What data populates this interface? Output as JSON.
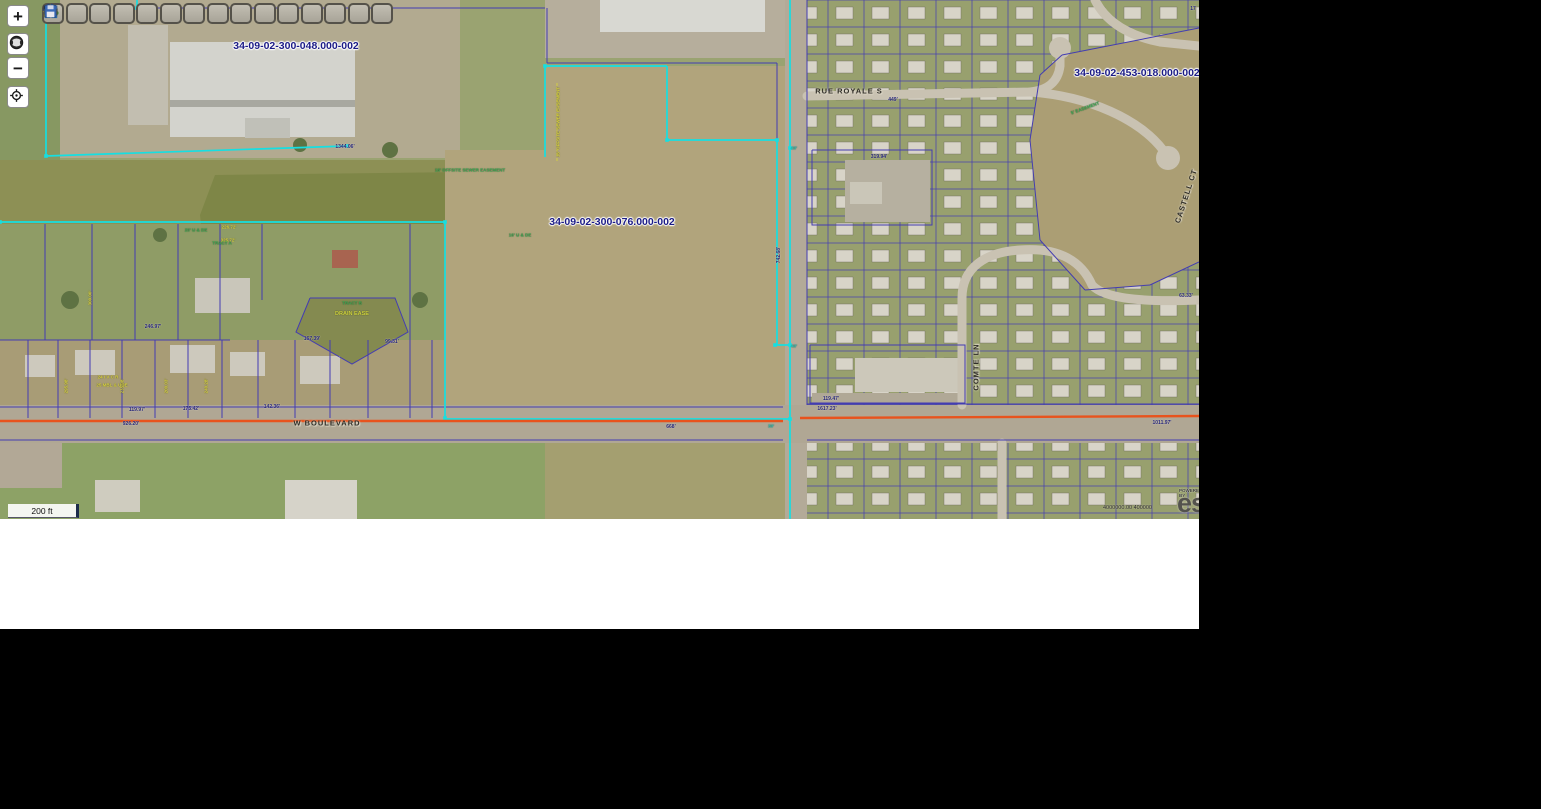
{
  "app": {
    "type": "gis-parcel-viewer"
  },
  "toolbar": {
    "buttons": [
      {
        "icon": "info"
      },
      {
        "icon": "identify-flash"
      },
      {
        "icon": "zoom-select"
      },
      {
        "icon": "pan-hand"
      },
      {
        "icon": "eraser"
      },
      {
        "icon": "add-data"
      },
      {
        "icon": "pushpin"
      },
      {
        "icon": "camera"
      },
      {
        "icon": "measure"
      },
      {
        "icon": "search"
      },
      {
        "icon": "draw-pencil"
      },
      {
        "icon": "select-features"
      },
      {
        "icon": "buffer"
      },
      {
        "icon": "print"
      },
      {
        "icon": "save"
      }
    ]
  },
  "nav": {
    "buttons": [
      {
        "icon": "zoom-in",
        "glyph": "+",
        "top": 5
      },
      {
        "icon": "full-extent-globe",
        "glyph": "",
        "top": 33
      },
      {
        "icon": "zoom-out",
        "glyph": "−",
        "top": 57
      },
      {
        "icon": "locate-crosshair",
        "glyph": "",
        "top": 86
      }
    ]
  },
  "scalebar": {
    "label": "200 ft"
  },
  "attribution": {
    "powered_by": "POWERED BY",
    "brand": "esri",
    "coords": "4000000.00 400000"
  },
  "map": {
    "w": 1199,
    "h": 519,
    "palette": {
      "navy": "#433cb2",
      "cyan": "#15dfe2",
      "orange": "#e8531d",
      "street": "#c9c2b2",
      "road": "#b3aa98",
      "lotbase": "#98a06e",
      "labelNavy": "#1b1b86",
      "labelGreen": "#3fae54",
      "labelYellow": "#d8d23e"
    },
    "fills": [
      {
        "k": "rect",
        "x": 0,
        "y": 0,
        "w": 1199,
        "h": 519,
        "f": "#a89c76"
      },
      {
        "k": "rect",
        "x": 0,
        "y": 0,
        "w": 790,
        "h": 160,
        "f": "#9aa371"
      },
      {
        "k": "rect",
        "x": 60,
        "y": 0,
        "w": 400,
        "h": 158,
        "f": "#b2aa90"
      },
      {
        "k": "rect",
        "x": 0,
        "y": 0,
        "w": 60,
        "h": 160,
        "f": "#879862"
      },
      {
        "k": "rect",
        "x": 128,
        "y": 25,
        "w": 40,
        "h": 100,
        "f": "#c2beb0"
      },
      {
        "k": "rect",
        "x": 170,
        "y": 42,
        "w": 185,
        "h": 95,
        "f": "#d3d3cd"
      },
      {
        "k": "rect",
        "x": 170,
        "y": 100,
        "w": 185,
        "h": 7,
        "f": "#a8a8a0"
      },
      {
        "k": "rect",
        "x": 245,
        "y": 118,
        "w": 45,
        "h": 20,
        "f": "#c0c0b8"
      },
      {
        "k": "rect",
        "x": 545,
        "y": 0,
        "w": 240,
        "h": 58,
        "f": "#b6ae9c"
      },
      {
        "k": "rect",
        "x": 600,
        "y": 0,
        "w": 165,
        "h": 32,
        "f": "#d8d8d2"
      },
      {
        "k": "rect",
        "x": 0,
        "y": 160,
        "w": 690,
        "h": 132,
        "f": "#8d9055"
      },
      {
        "k": "poly",
        "p": "215,175 640,170 668,200 672,250 650,282 240,288 205,260 200,215",
        "f": "#7e8647"
      },
      {
        "k": "rect",
        "x": 445,
        "y": 150,
        "w": 340,
        "h": 268,
        "f": "#b1a47c"
      },
      {
        "k": "rect",
        "x": 545,
        "y": 66,
        "w": 240,
        "h": 90,
        "f": "#b1a47c"
      },
      {
        "k": "rect",
        "x": 0,
        "y": 224,
        "w": 445,
        "h": 116,
        "f": "#8f9c66"
      },
      {
        "k": "circ",
        "cx": 70,
        "cy": 300,
        "r": 9,
        "f": "#5e7243"
      },
      {
        "k": "circ",
        "cx": 160,
        "cy": 235,
        "r": 7,
        "f": "#5e7243"
      },
      {
        "k": "circ",
        "cx": 420,
        "cy": 300,
        "r": 8,
        "f": "#5e7243"
      },
      {
        "k": "circ",
        "cx": 300,
        "cy": 145,
        "r": 7,
        "f": "#5e7243"
      },
      {
        "k": "circ",
        "cx": 390,
        "cy": 150,
        "r": 8,
        "f": "#5e7243"
      },
      {
        "k": "poly",
        "p": "310,298 395,298 408,332 352,364 296,332",
        "f": "#848a50"
      },
      {
        "k": "rect",
        "x": 195,
        "y": 278,
        "w": 55,
        "h": 35,
        "f": "#c9c6ba"
      },
      {
        "k": "rect",
        "x": 332,
        "y": 250,
        "w": 26,
        "h": 18,
        "f": "#a86450"
      },
      {
        "k": "rect",
        "x": 25,
        "y": 355,
        "w": 30,
        "h": 22,
        "f": "#cdc9bd"
      },
      {
        "k": "rect",
        "x": 75,
        "y": 350,
        "w": 40,
        "h": 25,
        "f": "#cdc9bd"
      },
      {
        "k": "rect",
        "x": 170,
        "y": 345,
        "w": 45,
        "h": 28,
        "f": "#cdc9bd"
      },
      {
        "k": "rect",
        "x": 230,
        "y": 352,
        "w": 35,
        "h": 24,
        "f": "#cdc9bd"
      },
      {
        "k": "rect",
        "x": 300,
        "y": 356,
        "w": 40,
        "h": 28,
        "f": "#cdc9bd"
      },
      {
        "k": "rect",
        "x": 785,
        "y": 0,
        "w": 22,
        "h": 519,
        "f": "#b3aa98"
      },
      {
        "k": "rect",
        "x": 0,
        "y": 405,
        "w": 1199,
        "h": 38,
        "f": "#b0a794"
      },
      {
        "k": "rect",
        "x": 0,
        "y": 443,
        "w": 545,
        "h": 76,
        "f": "#8da266"
      },
      {
        "k": "rect",
        "x": 285,
        "y": 480,
        "w": 72,
        "h": 39,
        "f": "#d6d3c9"
      },
      {
        "k": "rect",
        "x": 95,
        "y": 480,
        "w": 45,
        "h": 32,
        "f": "#cfccbf"
      },
      {
        "k": "rect",
        "x": 0,
        "y": 443,
        "w": 62,
        "h": 45,
        "f": "#b2a896"
      },
      {
        "k": "rect",
        "x": 545,
        "y": 443,
        "w": 240,
        "h": 76,
        "f": "#a49f70"
      }
    ],
    "pattern_blocks": [
      {
        "p": "807,0 1199,0 1199,405 807,405"
      },
      {
        "p": "807,443 1199,443 1199,519 807,519"
      }
    ],
    "post_fills": [
      {
        "k": "poly",
        "p": "1062,55 1199,28 1199,262 1150,285 1085,290 1040,240 1030,140 1040,75",
        "f": "#ab9e74"
      },
      {
        "k": "rect",
        "x": 845,
        "y": 160,
        "w": 85,
        "h": 62,
        "f": "#b6b0a0"
      },
      {
        "k": "rect",
        "x": 850,
        "y": 182,
        "w": 32,
        "h": 22,
        "f": "#cac6b8"
      },
      {
        "k": "rect",
        "x": 855,
        "y": 358,
        "w": 105,
        "h": 34,
        "f": "#ccc8ba"
      },
      {
        "k": "rect",
        "x": 812,
        "y": 393,
        "w": 150,
        "h": 11,
        "f": "#b0a896"
      }
    ],
    "streets": [
      {
        "d": "M807,96 L1030,92 C1048,90 1058,82 1060,66 L1060,55",
        "w": 9
      },
      {
        "d": "M1030,92 C1090,96 1140,120 1163,150",
        "w": 9
      },
      {
        "d": "M1095,0 C1105,20 1125,35 1160,42 L1199,46",
        "w": 9
      },
      {
        "d": "M962,405 L962,298 C962,268 985,252 1020,250 C1060,247 1082,262 1092,285 C1105,300 1150,302 1199,300",
        "w": 9
      },
      {
        "d": "M1002,443 L1002,519",
        "w": 9
      }
    ],
    "culdesacs": [
      {
        "cx": 1060,
        "cy": 48,
        "r": 11
      },
      {
        "cx": 1168,
        "cy": 158,
        "r": 12
      },
      {
        "cx": 1020,
        "cy": 250,
        "r": 2
      }
    ],
    "navy": [
      "0,340 230,340",
      "45,224 45,340",
      "92,224 92,340",
      "135,224 135,340",
      "178,224 178,340",
      "220,224 220,340",
      "262,224 262,300",
      "410,224 410,418",
      "310,298 395,298 408,332 352,364 296,332 310,298",
      "28,340 28,418",
      "58,340 58,418",
      "90,340 90,418",
      "122,340 122,418",
      "155,340 155,418",
      "188,340 188,418",
      "222,340 222,418",
      "258,340 258,418",
      "295,340 295,418",
      "330,340 330,418",
      "368,340 368,418",
      "432,340 432,418",
      "0,407 783,407",
      "0,440 783,440",
      "807,404 1199,404",
      "807,440 1199,440",
      "137,0 137,8",
      "137,8 545,8",
      "547,8 547,63",
      "547,63 777,63",
      "777,63 777,140",
      "807,0 807,405",
      "1062,55 1199,28",
      "1040,75 1062,55",
      "1030,140 1040,75",
      "1040,240 1030,140",
      "1085,290 1040,240",
      "1150,285 1085,290",
      "1199,262 1150,285",
      "812,150 932,150 932,225 812,225 812,150",
      "810,345 965,345 965,403 810,403 810,345"
    ],
    "cyan": [
      "137,0 137,8",
      "46,20 46,156",
      "46,156 347,146",
      "0,222 445,222",
      "445,222 445,418",
      "545,66 667,66",
      "667,66 667,140",
      "667,140 777,140",
      "777,140 777,345",
      "545,66 545,157",
      "790,0 790,519",
      "445,419 790,419",
      "775,345 790,345"
    ],
    "cyan_markers": [
      [
        137,
        8
      ],
      [
        46,
        156
      ],
      [
        347,
        146
      ],
      [
        0,
        222
      ],
      [
        445,
        222
      ],
      [
        445,
        418
      ],
      [
        545,
        66
      ],
      [
        667,
        140
      ],
      [
        777,
        140
      ],
      [
        790,
        148
      ],
      [
        790,
        345
      ],
      [
        790,
        419
      ],
      [
        775,
        345
      ]
    ],
    "orange": [
      {
        "d": "M0,421 L783,421",
        "w": 2.4
      },
      {
        "d": "M800,418 L1199,416",
        "w": 2.4
      }
    ],
    "dash": [
      {
        "d": "M557,83 L557,163"
      }
    ],
    "labels": [
      {
        "t": "34-09-02-300-048.000-002",
        "x": 296,
        "y": 46,
        "c": "pid"
      },
      {
        "t": "34-09-02-300-076.000-002",
        "x": 612,
        "y": 222,
        "c": "pid"
      },
      {
        "t": "34-09-02-453-018.000-002",
        "x": 1137,
        "y": 73,
        "c": "pid"
      },
      {
        "t": "W BOULEVARD",
        "x": 327,
        "y": 423,
        "c": "street"
      },
      {
        "t": "RUE ROYALE S",
        "x": 849,
        "y": 91,
        "c": "street"
      },
      {
        "t": "COMTE LN",
        "x": 976,
        "y": 367,
        "c": "street",
        "r": -90
      },
      {
        "t": "CASTELL CT",
        "x": 1186,
        "y": 196,
        "c": "street",
        "r": -72
      },
      {
        "t": "1344.06'",
        "x": 345,
        "y": 147,
        "c": "dim"
      },
      {
        "t": "742.68'",
        "x": 779,
        "y": 255,
        "c": "dim",
        "r": -90
      },
      {
        "t": "449'",
        "x": 893,
        "y": 100,
        "c": "dim"
      },
      {
        "t": "319.94'",
        "x": 879,
        "y": 157,
        "c": "dim"
      },
      {
        "t": "1617.23'",
        "x": 827,
        "y": 409,
        "c": "dim"
      },
      {
        "t": "668'",
        "x": 671,
        "y": 427,
        "c": "dim"
      },
      {
        "t": "1011.97'",
        "x": 1162,
        "y": 423,
        "c": "dim"
      },
      {
        "t": "119.97'",
        "x": 137,
        "y": 410,
        "c": "dim"
      },
      {
        "t": "175.42'",
        "x": 191,
        "y": 409,
        "c": "dim"
      },
      {
        "t": "142.36'",
        "x": 272,
        "y": 407,
        "c": "dim"
      },
      {
        "t": "246.97'",
        "x": 153,
        "y": 327,
        "c": "dim"
      },
      {
        "t": "167.39'",
        "x": 312,
        "y": 339,
        "c": "dim"
      },
      {
        "t": "99.31'",
        "x": 392,
        "y": 342,
        "c": "dim"
      },
      {
        "t": "119.47'",
        "x": 831,
        "y": 399,
        "c": "dim"
      },
      {
        "t": "926.20'",
        "x": 131,
        "y": 424,
        "c": "dim"
      },
      {
        "t": "63.33'",
        "x": 1186,
        "y": 296,
        "c": "dim"
      },
      {
        "t": "17",
        "x": 1193,
        "y": 9,
        "c": "dim"
      },
      {
        "t": "30'",
        "x": 771,
        "y": 426,
        "c": "teal"
      },
      {
        "t": "40'",
        "x": 794,
        "y": 148,
        "c": "teal"
      },
      {
        "t": "40'",
        "x": 794,
        "y": 346,
        "c": "teal"
      },
      {
        "t": "325.72'",
        "x": 228,
        "y": 240,
        "c": "yel"
      },
      {
        "t": "226.72'",
        "x": 229,
        "y": 227,
        "c": "yel"
      },
      {
        "t": "300.00'",
        "x": 90,
        "y": 298,
        "c": "yel",
        "r": -90
      },
      {
        "t": "295.98'",
        "x": 66,
        "y": 386,
        "c": "yel",
        "r": -90
      },
      {
        "t": "235.08'",
        "x": 122,
        "y": 386,
        "c": "yel",
        "r": -90
      },
      {
        "t": "200.03'",
        "x": 166,
        "y": 386,
        "c": "yel",
        "r": -90
      },
      {
        "t": "240.28'",
        "x": 206,
        "y": 386,
        "c": "yel",
        "r": -90
      },
      {
        "t": "16' OFFSITE SEWER EASEMENT",
        "x": 470,
        "y": 170,
        "c": "grn"
      },
      {
        "t": "16' OFFSITE SEWER EASEMENT",
        "x": 558,
        "y": 122,
        "c": "yel",
        "r": -90
      },
      {
        "t": "TRACT A",
        "x": 222,
        "y": 243,
        "c": "grn"
      },
      {
        "t": "TRACT B",
        "x": 352,
        "y": 303,
        "c": "grn"
      },
      {
        "t": "DRAIN EASE",
        "x": 352,
        "y": 314,
        "c": "gy"
      },
      {
        "t": "20' U & DE",
        "x": 196,
        "y": 230,
        "c": "grn"
      },
      {
        "t": "16' U & DE",
        "x": 520,
        "y": 235,
        "c": "grn"
      },
      {
        "t": "24 I V C R",
        "x": 108,
        "y": 377,
        "c": "yel"
      },
      {
        "t": "25 MBL & UDE",
        "x": 112,
        "y": 385,
        "c": "yel"
      },
      {
        "t": "5' EASEMENT",
        "x": 1085,
        "y": 108,
        "c": "grn",
        "r": -20
      }
    ]
  }
}
